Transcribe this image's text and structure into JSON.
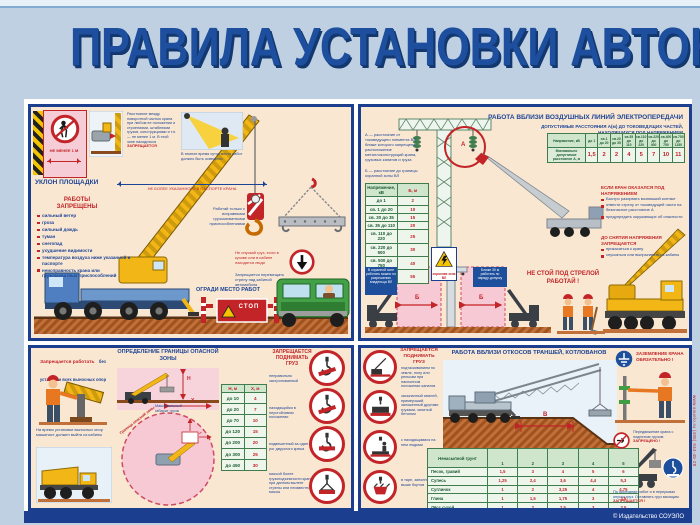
{
  "poster": {
    "title": "ПРАВИЛА УСТАНОВКИ АВТОКРАНОВ"
  },
  "panel_site": {
    "no_entry_label": "НЕ МЕНЕЕ 1 М",
    "clearance_text": "Расстояние между поворотной частью крана при любом ее положении и строениями, штабелями грузов, конструкциями и т.п. — не менее 1 м. В этой зоне находиться",
    "clearance_forbidden": "ЗАПРЕЩАЕТСЯ",
    "night_caption": "В темное время суток место работ должно быть освещено",
    "slope_label": "УКЛОН ПЛОЩАДКИ",
    "slope_note": "НЕ БОЛЕЕ УКАЗАННОГО В ПАСПОРТЕ КРАНА",
    "forbidden_title": "РАБОТЫ ЗАПРЕЩЕНЫ",
    "forbidden_items": [
      "сильный ветер",
      "гроза",
      "сильный дождь",
      "туман",
      "снегопад",
      "ухудшение видимости",
      "температура воздуха ниже указанной в паспорте",
      "неисправность крана или грузозахватных приспособлений"
    ],
    "rigging_note": "Работай только с исправными грузозахватными приспособлениями",
    "lowering_note": "Не опускай груз, если в кузове или в кабине находятся люди",
    "boom_note": "Запрещается перемещать стрелу над кабиной автомобиля",
    "fence_label": "ОГРАДИ МЕСТО РАБОТ",
    "stop_label": "СТОП"
  },
  "panel_power": {
    "title": "РАБОТА ВБЛИЗИ ВОЗДУШНЫХ ЛИНИЙ ЭЛЕКТРОПЕРЕДАЧИ",
    "subtitle1": "ДОПУСТИМЫЕ РАССТОЯНИЯ А(м) ДО ТОКОВЕДУЩИХ ЧАСТЕЙ,",
    "subtitle2": "НАХОДЯЩИХСЯ ПОД НАПРЯЖЕНИЕМ",
    "def_a": "А — расстояние от токоведущего элемента ВЛ, ближе которого запрещено расположение металлоконструкций крана, грузовых канатов и груза",
    "def_b": "Б — расстояние до границы охранной зоны ВЛ",
    "a_mark": "А",
    "b_mark": "Б",
    "table_a": {
      "headers": [
        "Напряжение, кВ",
        "до 1",
        "св.1 до 20",
        "св.20 до 35",
        "св.35 до 110",
        "св.110 до 220",
        "св.220 до 400",
        "св.400 до 750",
        "св.750 до 1150"
      ],
      "rows": [
        [
          "Минимально допустимое расстояние А, м",
          "1,5",
          "2",
          "2",
          "4",
          "5",
          "7",
          "10",
          "11"
        ]
      ]
    },
    "table_b": {
      "headers": [
        "Напряжение, кВ",
        "Б, м"
      ],
      "rows": [
        [
          "до 1",
          "2"
        ],
        [
          "св. 1 до 20",
          "10"
        ],
        [
          "св. 20 до 35",
          "15"
        ],
        [
          "св. 35 до 110",
          "20"
        ],
        [
          "св. 110 до 220",
          "25"
        ],
        [
          "св. 220 до 500",
          "30"
        ],
        [
          "св. 500 до 750",
          "40"
        ],
        [
          "св. 750 до 1150",
          "55"
        ]
      ]
    },
    "warning_sign_caption": "охранная зона ВЛ",
    "zone_note_left": "В охранной зоне работать можно по разрешению владельца ВЛ",
    "zone_note_right": "Ближе 30 м работать по наряду-допуску",
    "energized_title": "ЕСЛИ КРАН ОКАЗАЛСЯ ПОД НАПРЯЖЕНИЕМ",
    "energized_items": [
      "Быстро разорвать возникший контакт",
      "отвести стрелу от токоведущей части на безопасное расстояние А",
      "предупредить окружающих об опасности"
    ],
    "until_title": "ДО СНЯТИЯ НАПРЯЖЕНИЯ ЗАПРЕЩАЕТСЯ",
    "until_items": [
      "прикасаться к крану",
      "спускаться или выпрыгивать из кабины"
    ],
    "slogan1": "НЕ СТОЙ ПОД СТРЕЛОЙ",
    "slogan2": "РАБОТАЙ !"
  },
  "panel_zone": {
    "outrigger_warning_red": "Запрещается работать",
    "outrigger_warning_rest": "без установки всех выносных опор",
    "outrigger_note": "На время установки выносных опор машинист должен выйти из кабины",
    "title": "ОПРЕДЕЛЕНИЕ ГРАНИЦЫ ОПАСНОЙ ЗОНЫ",
    "boundary_label": "Граница опасной зоны",
    "load_label": "Максимальный габарит груза",
    "h_mark": "Н",
    "x_mark": "X",
    "table": {
      "headers": [
        "Н, м",
        "X, м"
      ],
      "rows": [
        [
          "до 10",
          "4"
        ],
        [
          "до 20",
          "7"
        ],
        [
          "до 70",
          "10"
        ],
        [
          "до 120",
          "15"
        ],
        [
          "до 200",
          "20"
        ],
        [
          "до 300",
          "25"
        ],
        [
          "до 450",
          "30"
        ]
      ]
    },
    "lift_title": "ЗАПРЕЩАЕТСЯ ПОДНИМАТЬ ГРУЗ",
    "lift_items": [
      "неправильно застропованный",
      "находящийся в неустойчивом положении",
      "подвешенный за один рог двурогого крюка",
      "массой более грузоподъемности крана при данном вылете стрелы или неизвестной массы"
    ]
  },
  "panel_trench": {
    "lift_title": "ЗАПРЕЩАЕТСЯ ПОДНИМАТЬ ГРУЗ",
    "lift_items": [
      "подтаскиванием по земле, полу или рельсам при наклонном положении канатов",
      "засыпанный землей, примерзший, заложенный другими грузами, залитый бетоном",
      "с находящимися на нем людьми",
      "в таре, заполненной выше бортов"
    ],
    "title": "РАБОТА ВБЛИЗИ ОТКОСОВ ТРАНШЕЙ, КОТЛОВАНОВ",
    "v_mark": "В",
    "table_caption": "Безопасное расстояние В(м) при глубине котлована, м",
    "table": {
      "headers": [
        "Ненасыпной грунт",
        "1",
        "2",
        "3",
        "4",
        "5"
      ],
      "rows": [
        [
          "Песок, гравий",
          "1,5",
          "3",
          "4",
          "5",
          "6"
        ],
        [
          "Супесь",
          "1,25",
          "2,4",
          "3,6",
          "4,4",
          "5,3"
        ],
        [
          "Суглинок",
          "1",
          "2",
          "3,25",
          "4",
          "4,75"
        ],
        [
          "Глина",
          "1",
          "1,5",
          "1,75",
          "3",
          "3,5"
        ],
        [
          "Лёсс сухой",
          "1",
          "2",
          "2,5",
          "3",
          "3,5"
        ]
      ]
    },
    "grounding_label": "ЗАЗЕМЛЕНИЕ КРАНА ОБЯЗАТЕЛЬНО !",
    "move_note": "Передвижение крана с поднятым грузом",
    "move_forbidden": "ЗАПРЕЩЕНО !",
    "end_note": "По окончании работ и в перерывах опусти груз. Оставлять груз висящим",
    "end_forbidden": "ЗАПРЕЩАЕТСЯ !"
  },
  "footer": {
    "publisher": "© Издательство СОУЭЛО",
    "website": "www.souelo.ru (495) 944-45-28"
  }
}
